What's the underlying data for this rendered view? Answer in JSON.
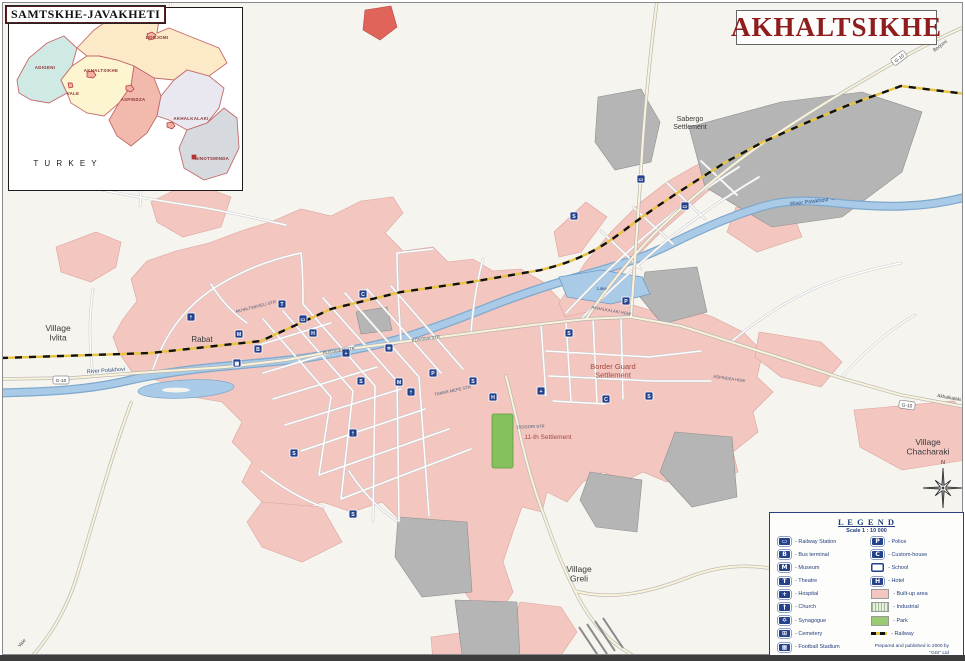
{
  "title": "AKHALTSIKHE",
  "inset": {
    "title": "SAMTSKHE-JAVAKHETI",
    "country_label": "T U R K E Y",
    "districts": [
      {
        "name": "ADIGENI",
        "x": 36,
        "y": 61
      },
      {
        "name": "BORJOMI",
        "x": 148,
        "y": 31
      },
      {
        "name": "AKHALTSIKHE",
        "x": 92,
        "y": 64
      },
      {
        "name": "VALE",
        "x": 64,
        "y": 87
      },
      {
        "name": "ASPINDZA",
        "x": 124,
        "y": 93
      },
      {
        "name": "AKHALKALAKI",
        "x": 182,
        "y": 112
      },
      {
        "name": "NINOTSMINDA",
        "x": 203,
        "y": 152
      }
    ]
  },
  "map": {
    "place_labels": [
      {
        "lines": [
          "Village",
          "Ivlita"
        ],
        "x": 57,
        "y": 330,
        "size": 8.5,
        "color": "#3a3a3a"
      },
      {
        "lines": [
          "Rabat"
        ],
        "x": 201,
        "y": 341,
        "size": 8,
        "color": "#3a3a3a"
      },
      {
        "lines": [
          "Sabergo",
          "Settlement"
        ],
        "x": 689,
        "y": 120,
        "size": 7,
        "color": "#3a3a3a"
      },
      {
        "lines": [
          "Border Guard",
          "Settlement"
        ],
        "x": 612,
        "y": 368,
        "size": 7.5,
        "color": "#a3493f"
      },
      {
        "lines": [
          "11-th Settlement"
        ],
        "x": 547,
        "y": 438,
        "size": 6.5,
        "color": "#a3493f"
      },
      {
        "lines": [
          "Village",
          "Greli"
        ],
        "x": 578,
        "y": 571,
        "size": 8.5,
        "color": "#3a3a3a"
      },
      {
        "lines": [
          "Village",
          "Chacharaki"
        ],
        "x": 927,
        "y": 444,
        "size": 8.5,
        "color": "#3a3a3a"
      },
      {
        "lines": [
          "Lake"
        ],
        "x": 601,
        "y": 289,
        "size": 4.5,
        "color": "#2e4d7b"
      },
      {
        "lines": [
          "River Potskhovi →"
        ],
        "x": 812,
        "y": 202,
        "size": 5.5,
        "color": "#2e4d7b",
        "rotate": -7
      },
      {
        "lines": [
          "River Potskhovi"
        ],
        "x": 105,
        "y": 371,
        "size": 5.5,
        "color": "#2e4d7b",
        "rotate": -4
      }
    ],
    "street_labels": [
      {
        "text": "RUSTAVELI STR",
        "x": 338,
        "y": 351,
        "rotate": -8
      },
      {
        "text": "KOSTAVA STR",
        "x": 425,
        "y": 339,
        "rotate": -8
      },
      {
        "text": "AKHALKALAKI HGW",
        "x": 610,
        "y": 311,
        "rotate": 10
      },
      {
        "text": "ASPINDZA HGW",
        "x": 728,
        "y": 379,
        "rotate": 8
      },
      {
        "text": "TAMAR MEPE STR",
        "x": 452,
        "y": 391,
        "rotate": -12
      },
      {
        "text": "DIDGORI STR",
        "x": 530,
        "y": 427,
        "rotate": -2
      },
      {
        "text": "AKHALTSIKHELI STR",
        "x": 255,
        "y": 307,
        "rotate": -14
      }
    ],
    "destinations": [
      {
        "text": "Borjomi",
        "x": 940,
        "y": 46,
        "rotate": -37
      },
      {
        "text": "Akhalkalaki",
        "x": 948,
        "y": 398,
        "rotate": 10
      },
      {
        "text": "Vale",
        "x": 22,
        "y": 643,
        "rotate": -48
      }
    ],
    "road_shields": [
      {
        "text": "G-10",
        "x": 898,
        "y": 57,
        "rotate": -37
      },
      {
        "text": "G-10",
        "x": 906,
        "y": 404,
        "rotate": 8
      },
      {
        "text": "G-10",
        "x": 60,
        "y": 379,
        "rotate": 0
      }
    ],
    "markers": [
      {
        "x": 362,
        "y": 293,
        "glyph": "C",
        "name": "cinema"
      },
      {
        "x": 238,
        "y": 333,
        "glyph": "M",
        "name": "museum"
      },
      {
        "x": 190,
        "y": 316,
        "glyph": "†",
        "name": "church"
      },
      {
        "x": 281,
        "y": 303,
        "glyph": "T",
        "name": "theatre"
      },
      {
        "x": 302,
        "y": 318,
        "glyph": "▭",
        "name": "railway-station"
      },
      {
        "x": 312,
        "y": 332,
        "glyph": "H",
        "name": "hotel"
      },
      {
        "x": 345,
        "y": 352,
        "glyph": "+",
        "name": "hospital"
      },
      {
        "x": 360,
        "y": 380,
        "glyph": "S",
        "name": "school"
      },
      {
        "x": 388,
        "y": 347,
        "glyph": "✡",
        "name": "synagogue"
      },
      {
        "x": 398,
        "y": 381,
        "glyph": "M",
        "name": "museum"
      },
      {
        "x": 410,
        "y": 391,
        "glyph": "†",
        "name": "church"
      },
      {
        "x": 432,
        "y": 372,
        "glyph": "P",
        "name": "police"
      },
      {
        "x": 352,
        "y": 432,
        "glyph": "†",
        "name": "church"
      },
      {
        "x": 293,
        "y": 452,
        "glyph": "S",
        "name": "school"
      },
      {
        "x": 472,
        "y": 380,
        "glyph": "S",
        "name": "school"
      },
      {
        "x": 492,
        "y": 396,
        "glyph": "H",
        "name": "hotel"
      },
      {
        "x": 568,
        "y": 332,
        "glyph": "S",
        "name": "school"
      },
      {
        "x": 540,
        "y": 390,
        "glyph": "+",
        "name": "hospital"
      },
      {
        "x": 573,
        "y": 215,
        "glyph": "S",
        "name": "school"
      },
      {
        "x": 640,
        "y": 178,
        "glyph": "▭",
        "name": "railway-station"
      },
      {
        "x": 684,
        "y": 205,
        "glyph": "▭",
        "name": "railway-station"
      },
      {
        "x": 625,
        "y": 300,
        "glyph": "P",
        "name": "police"
      },
      {
        "x": 605,
        "y": 398,
        "glyph": "C",
        "name": "custom-house"
      },
      {
        "x": 648,
        "y": 395,
        "glyph": "S",
        "name": "school"
      },
      {
        "x": 352,
        "y": 513,
        "glyph": "S",
        "name": "school"
      },
      {
        "x": 257,
        "y": 348,
        "glyph": "B",
        "name": "bus-terminal"
      },
      {
        "x": 236,
        "y": 362,
        "glyph": "▦",
        "name": "stadium"
      }
    ],
    "compass": {
      "label": "N",
      "x": 942,
      "y": 487
    }
  },
  "legend": {
    "title": "L E G E N D",
    "scale": "Scale 1 : 10 000",
    "left": [
      {
        "icon": "railway-station",
        "label": "Railway Station"
      },
      {
        "icon": "bus-terminal",
        "label": "Bus terminal"
      },
      {
        "icon": "museum",
        "label": "Museum"
      },
      {
        "icon": "theatre",
        "label": "Theatre"
      },
      {
        "icon": "hospital",
        "label": "Hospital"
      },
      {
        "icon": "church",
        "label": "Church"
      },
      {
        "icon": "synagogue",
        "label": "Synagogue"
      },
      {
        "icon": "cemetery",
        "label": "Cemetery"
      },
      {
        "icon": "stadium",
        "label": "Football Stadium"
      }
    ],
    "right": [
      {
        "icon": "police",
        "label": "Police"
      },
      {
        "icon": "custom-house",
        "label": "Custom-house"
      },
      {
        "icon": "school",
        "label": "School"
      },
      {
        "icon": "hotel",
        "label": "Hotel"
      },
      {
        "icon": "built-up",
        "label": "Built-up area"
      },
      {
        "icon": "industrial",
        "label": "Industrial"
      },
      {
        "icon": "park",
        "label": "Park"
      },
      {
        "icon": "railway",
        "label": "Railway"
      }
    ],
    "credits": [
      "Prepared and published in 2000 by \"GIS\" Ltd",
      "http://maps.ge"
    ]
  },
  "colors": {
    "title_red": "#8f1d1d",
    "marker_navy": "#24418c",
    "built_up_pink": "#f3c6c0",
    "industrial_gray": "#b5b5b5",
    "river_blue": "#a9cbe7",
    "park_green": "#85c25d",
    "railway_yellow": "#e6c340",
    "legend_navy": "#233d7d"
  }
}
